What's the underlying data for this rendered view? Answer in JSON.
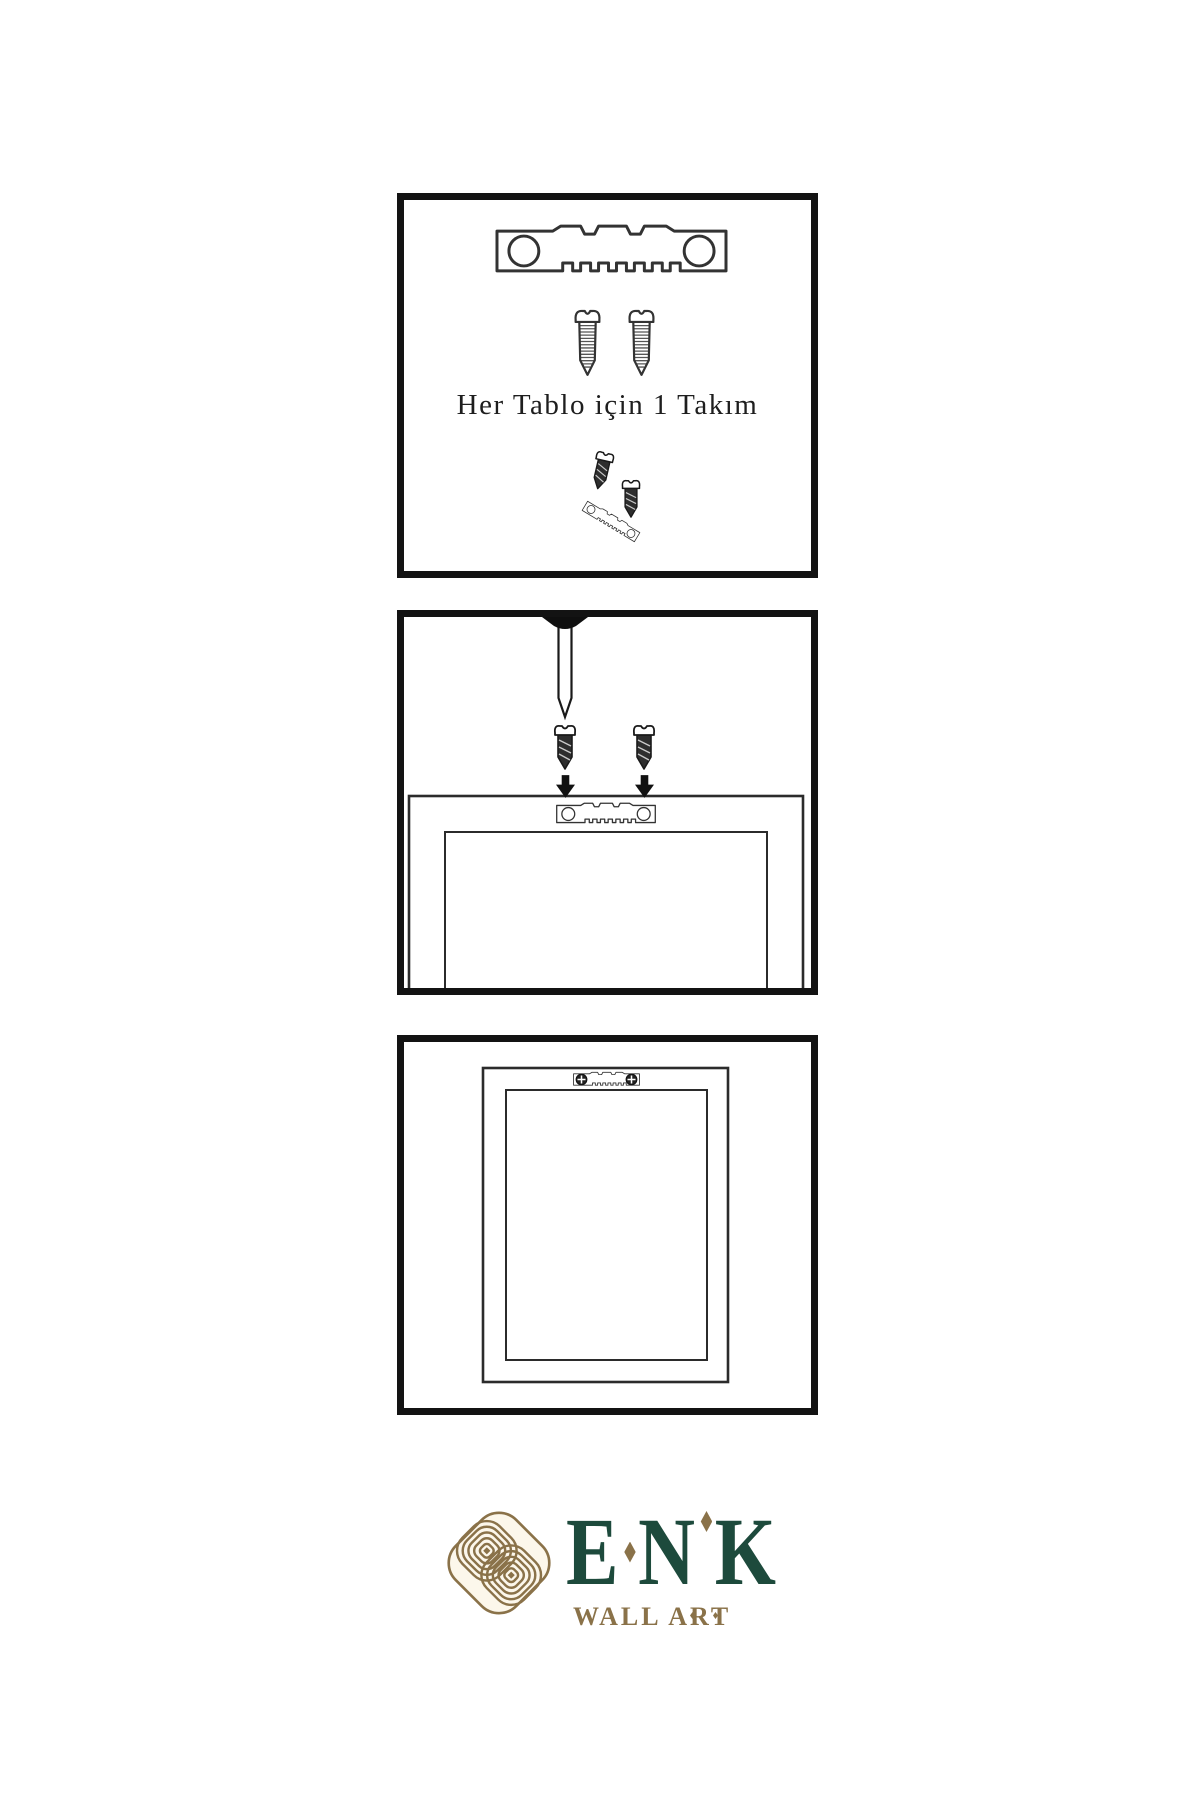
{
  "panel_kit": {
    "caption": "Her Tablo için 1 Takım",
    "depicts": [
      "sawtooth-hanger",
      "screw",
      "screw",
      "screw-driven-into-tilted-hanger"
    ]
  },
  "panel_mount": {
    "depicts": [
      "wall-nail-under-top-edge",
      "two-screws-with-down-arrows",
      "frame-back-with-sawtooth-hanger"
    ]
  },
  "panel_hang": {
    "depicts": [
      "frame-back-hung-with-sawtooth-hanger-and-phillips-screws"
    ]
  },
  "brand": {
    "letters": [
      "E",
      "N",
      "K"
    ],
    "tagline": "WALL ART",
    "emblem": "interlaced-knot",
    "colors": {
      "green": "#1d4a3c",
      "gold": "#8a7249",
      "cream": "#fcf7eb"
    }
  },
  "colors": {
    "panel_border": "#131313",
    "ink": "#1e1e1e",
    "paper": "#ffffff"
  }
}
